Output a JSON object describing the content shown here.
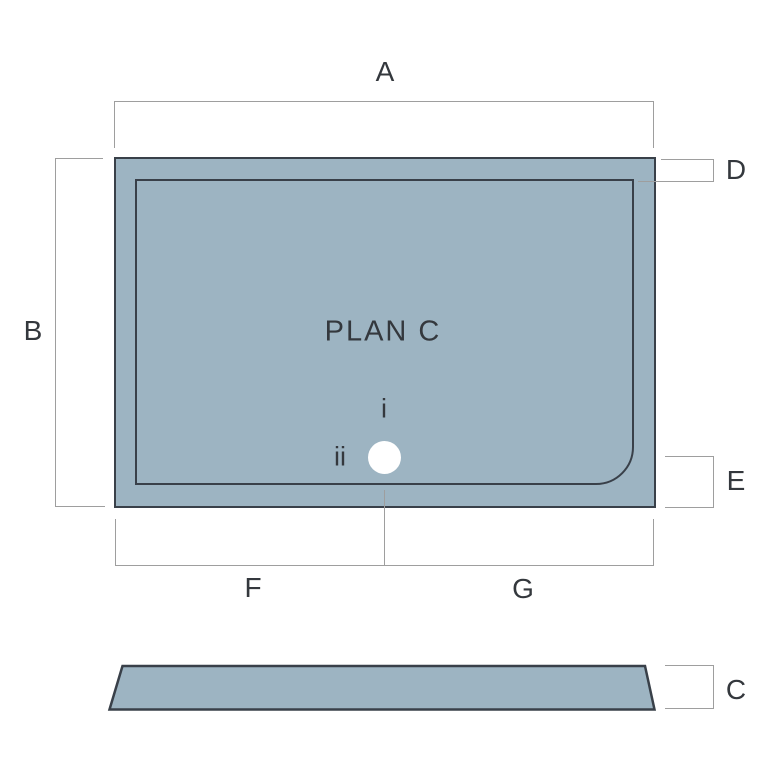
{
  "drawing": {
    "plan_label": "PLAN C",
    "marker_i": "i",
    "marker_ii": "ii",
    "dim_labels": {
      "a": "A",
      "b": "B",
      "c": "C",
      "d": "D",
      "e": "E",
      "f": "F",
      "g": "G"
    },
    "colors": {
      "canvas_bg": "#ffffff",
      "tray_fill": "#9db4c2",
      "tray_stroke": "#394049",
      "dim_line": "#9e9e9e",
      "label_text": "#34383d",
      "waste_fill": "#ffffff"
    }
  }
}
